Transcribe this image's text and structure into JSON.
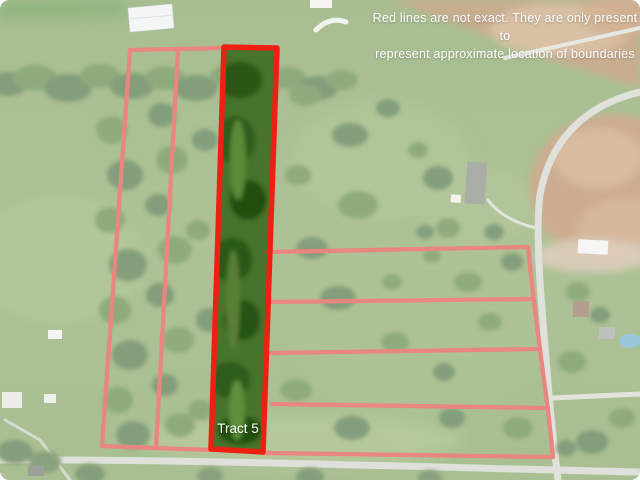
{
  "map_overlay": {
    "disclaimer_line1": "Red lines are not exact. They are only present to",
    "disclaimer_line2": "represent approximate location of boundaries",
    "highlighted_tract_label": "Tract 5"
  },
  "colors": {
    "highlight_boundary_red": "#ee2014",
    "faded_boundary_red": "#d4705f",
    "fade_overlay_white": "#ffffff",
    "disclaimer_text": "#ffffff",
    "tract_label_text": "#ffffff",
    "field_green": "#6d9346",
    "tract5_interior_green": "#47732b",
    "road_gray": "#c8ccc0",
    "dirt_tan": "#a8713f"
  }
}
